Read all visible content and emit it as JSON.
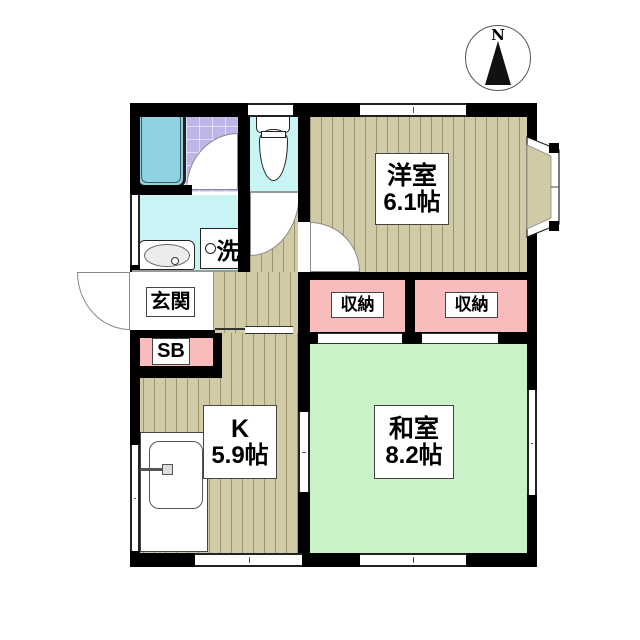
{
  "compass": {
    "label": "N"
  },
  "rooms": {
    "western": {
      "name": "洋室",
      "size": "6.1帖"
    },
    "japanese": {
      "name": "和室",
      "size": "8.2帖"
    },
    "kitchen": {
      "name": "K",
      "size": "5.9帖"
    },
    "entrance": {
      "label": "玄関"
    },
    "shoebox": {
      "label": "SB"
    }
  },
  "storages": [
    {
      "label": "収納"
    },
    {
      "label": "収納"
    }
  ],
  "fixtures": {
    "laundry": {
      "label": "洗"
    }
  },
  "colors": {
    "wall": "#000000",
    "wood": "#d1caa7",
    "woodline": "rgba(95,85,45,0.45)",
    "tatami": "#c9f2c9",
    "pink": "#f8bcbc",
    "cyan": "#c9f4f5",
    "tile": "#beb5e8",
    "tileline": "rgba(255,255,255,0.55)",
    "tub": "#8fd2e2"
  }
}
